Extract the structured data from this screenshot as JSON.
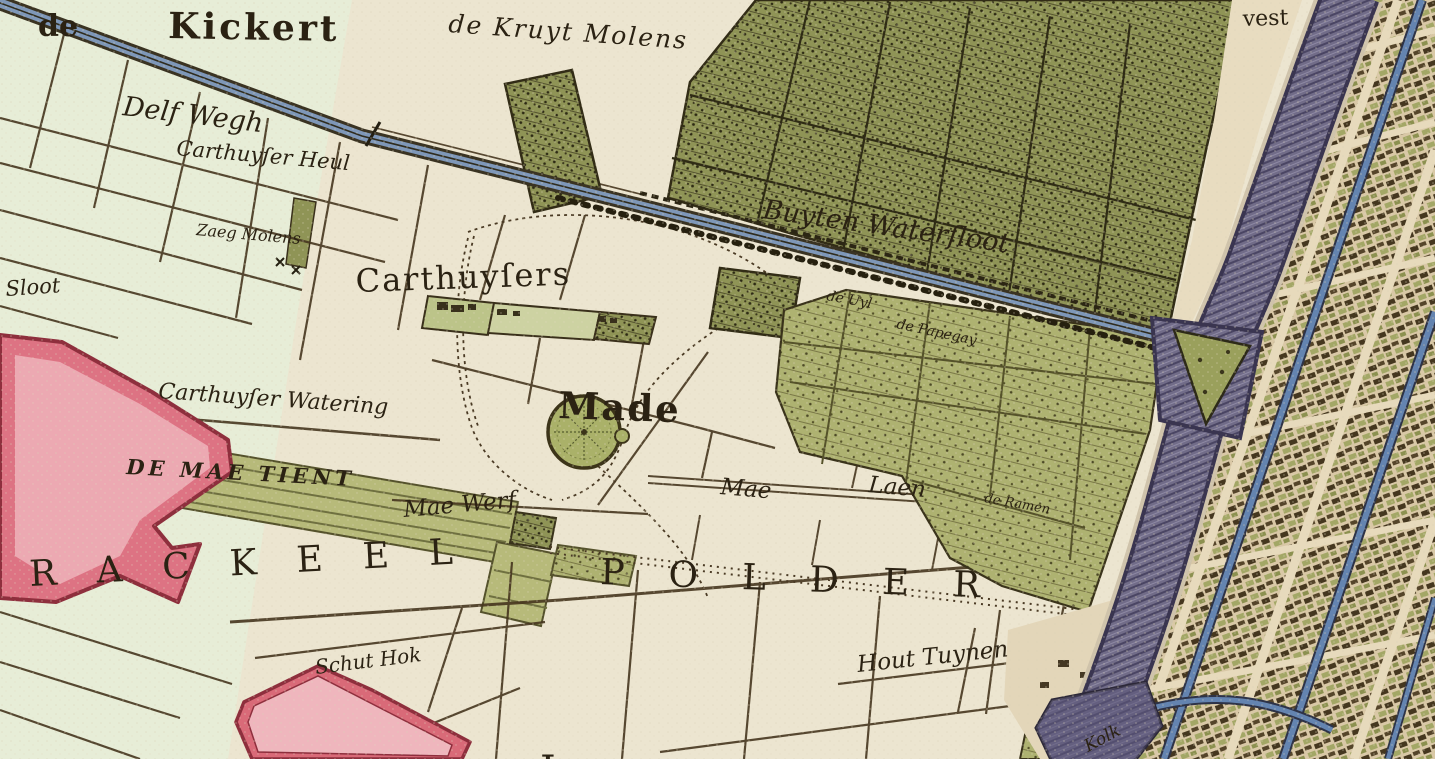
{
  "map": {
    "labels": {
      "de": "de",
      "kickert": "Kickert",
      "kruyt_molens": "de Kruyt Molens",
      "delf_wegh": "Delf Wegh",
      "carthuyser_heul": "Carthuyſer Heul",
      "zaeg_molens": "Zaeg Molens",
      "sloot": "Sloot",
      "buyten_watersloot": "Buyten Waterſloot",
      "de_uyl": "de Uyl",
      "de_papegay": "de Papegay",
      "carthuysers": "Carthuyſers",
      "carthuyser_watering": "Carthuyſer Watering",
      "made": "Made",
      "de_mae_tient": "DE MAE TIENT",
      "mae_werf": "Mae Werf",
      "mae": "Mae",
      "laen": "Laen",
      "de_ramen": "de Ramen",
      "rackeel": "RACKEEL",
      "polder": "POLDER",
      "schut_hok": "Schut Hok",
      "hout_tuynen": "Hout Tuynen",
      "vest": "vest",
      "kolk": "Kolk",
      "partial_letter": "L"
    },
    "palette": {
      "parchment": "#ece5d0",
      "polder_green": "#e7edd7",
      "garden_dark": "#8f9456",
      "garden_light": "#aeb271",
      "canal_blue": "#7e97b8",
      "moat_purple": "#716c88",
      "city_tan": "#d9c8a6",
      "red_outline": "#8e2f3d",
      "red_fill": "#dd7383",
      "pink_fill": "#eeb3bb",
      "ink": "#2b2213"
    }
  }
}
